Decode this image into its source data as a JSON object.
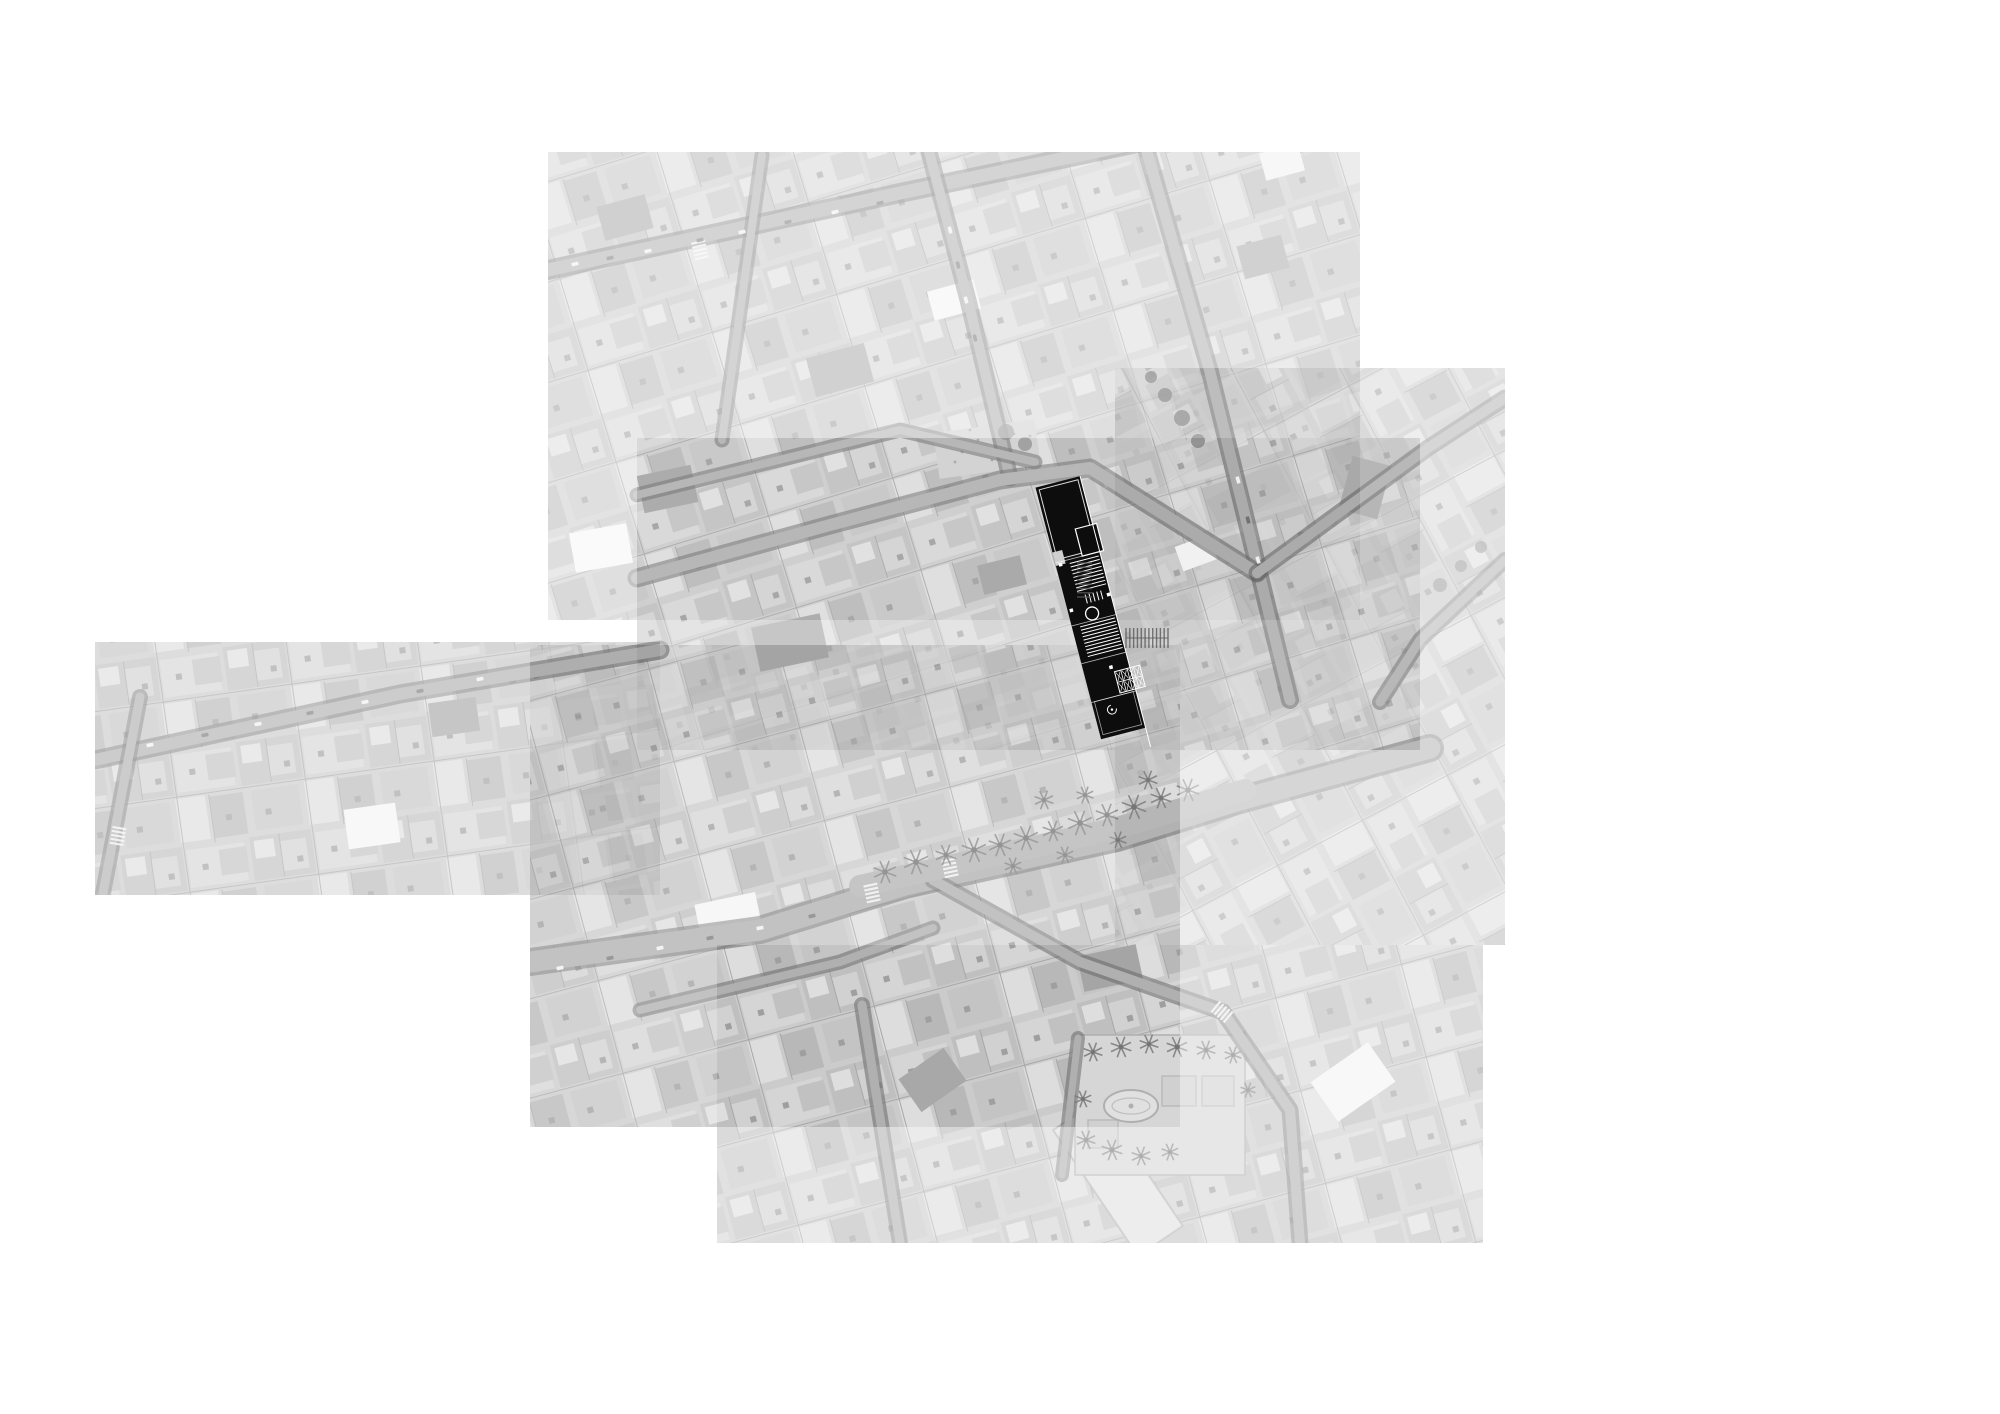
{
  "title": "aerial-orthophoto-site-montage",
  "colors": {
    "background": "#ffffff",
    "photo_base": "#bdbdbd",
    "street_dark": "#3f3f3f",
    "street_light": "#9b9b9b",
    "plan_black": "#0d0d0d",
    "plan_lines": "#ffffff",
    "palm": "#565656",
    "tree": "#6b6b6b",
    "car_light": "#ececec",
    "car_dark": "#555555",
    "plaza_fill": "#cccccc",
    "plaza_line": "#9a9a9a"
  },
  "montage": {
    "tiles": [
      {
        "name": "tile-top",
        "x": 548,
        "y": 152,
        "w": 812,
        "h": 468,
        "opacity": 0.42,
        "angle": -17
      },
      {
        "name": "tile-right",
        "x": 1115,
        "y": 368,
        "w": 390,
        "h": 577,
        "opacity": 0.4,
        "angle": 62
      },
      {
        "name": "tile-center",
        "x": 637,
        "y": 438,
        "w": 783,
        "h": 312,
        "opacity": 0.5,
        "angle": -17
      },
      {
        "name": "tile-left",
        "x": 95,
        "y": 642,
        "w": 565,
        "h": 253,
        "opacity": 0.5,
        "angle": -8
      },
      {
        "name": "tile-bottom",
        "x": 530,
        "y": 645,
        "w": 650,
        "h": 482,
        "opacity": 0.6,
        "angle": -15
      },
      {
        "name": "tile-bottom-right",
        "x": 717,
        "y": 945,
        "w": 766,
        "h": 298,
        "opacity": 0.45,
        "angle": -15
      }
    ],
    "streets": [
      {
        "name": "street-top-diagonal",
        "w": 16,
        "pts": [
          [
            548,
            270
          ],
          [
            900,
            193
          ],
          [
            1360,
            96
          ]
        ]
      },
      {
        "name": "street-top-vertical-1",
        "w": 11,
        "pts": [
          [
            762,
            155
          ],
          [
            722,
            440
          ]
        ]
      },
      {
        "name": "street-top-vertical-2",
        "w": 13,
        "pts": [
          [
            928,
            148
          ],
          [
            968,
            300
          ],
          [
            1010,
            478
          ]
        ]
      },
      {
        "name": "street-tree-lined",
        "w": 14,
        "pts": [
          [
            1147,
            152
          ],
          [
            1210,
            372
          ],
          [
            1290,
            700
          ]
        ]
      },
      {
        "name": "street-upper-center",
        "w": 11,
        "pts": [
          [
            637,
            495
          ],
          [
            900,
            430
          ],
          [
            1035,
            462
          ]
        ]
      },
      {
        "name": "street-main-center",
        "w": 15,
        "pts": [
          [
            637,
            578
          ],
          [
            830,
            525
          ],
          [
            1000,
            480
          ],
          [
            1090,
            468
          ],
          [
            1257,
            573
          ]
        ]
      },
      {
        "name": "street-right-ne-1",
        "w": 13,
        "pts": [
          [
            1257,
            573
          ],
          [
            1428,
            448
          ],
          [
            1505,
            398
          ]
        ]
      },
      {
        "name": "street-right-ne-2",
        "w": 12,
        "pts": [
          [
            1505,
            560
          ],
          [
            1420,
            640
          ],
          [
            1380,
            702
          ]
        ]
      },
      {
        "name": "street-left-west",
        "w": 15,
        "pts": [
          [
            95,
            760
          ],
          [
            400,
            694
          ],
          [
            660,
            650
          ]
        ]
      },
      {
        "name": "street-left-vertical",
        "w": 12,
        "pts": [
          [
            140,
            697
          ],
          [
            103,
            893
          ]
        ]
      },
      {
        "name": "avenue-palms",
        "w": 24,
        "pts": [
          [
            530,
            962
          ],
          [
            760,
            930
          ],
          [
            905,
            885
          ],
          [
            1117,
            838
          ],
          [
            1240,
            800
          ],
          [
            1430,
            748
          ]
        ]
      },
      {
        "name": "street-bottom-1",
        "w": 11,
        "pts": [
          [
            640,
            1010
          ],
          [
            840,
            962
          ],
          [
            933,
            928
          ]
        ]
      },
      {
        "name": "street-bottom-2",
        "w": 12,
        "pts": [
          [
            862,
            1005
          ],
          [
            900,
            1243
          ]
        ]
      },
      {
        "name": "street-plaza-edge",
        "w": 13,
        "pts": [
          [
            933,
            880
          ],
          [
            1080,
            962
          ],
          [
            1223,
            1012
          ],
          [
            1290,
            1110
          ],
          [
            1300,
            1243
          ]
        ]
      },
      {
        "name": "street-plaza-left",
        "w": 10,
        "pts": [
          [
            1078,
            1038
          ],
          [
            1062,
            1175
          ]
        ]
      }
    ],
    "median_band": {
      "w": 22,
      "pts": [
        [
          860,
          886
        ],
        [
          1117,
          828
        ],
        [
          1245,
          790
        ]
      ]
    },
    "palms_avenue": [
      [
        885,
        872,
        12
      ],
      [
        916,
        862,
        13
      ],
      [
        946,
        855,
        11
      ],
      [
        974,
        850,
        13
      ],
      [
        1000,
        845,
        12
      ],
      [
        1026,
        838,
        13
      ],
      [
        1053,
        831,
        11
      ],
      [
        1080,
        823,
        13
      ],
      [
        1107,
        815,
        12
      ],
      [
        1134,
        807,
        13
      ],
      [
        1161,
        798,
        11
      ],
      [
        1188,
        790,
        12
      ],
      [
        1013,
        866,
        9
      ],
      [
        1065,
        855,
        9
      ],
      [
        1118,
        840,
        9
      ],
      [
        1044,
        800,
        10
      ],
      [
        1085,
        795,
        9
      ],
      [
        1148,
        780,
        10
      ]
    ],
    "palms_plaza": [
      [
        1093,
        1052,
        10
      ],
      [
        1121,
        1047,
        11
      ],
      [
        1149,
        1044,
        10
      ],
      [
        1177,
        1047,
        11
      ],
      [
        1206,
        1050,
        10
      ],
      [
        1233,
        1055,
        9
      ],
      [
        1083,
        1099,
        9
      ],
      [
        1086,
        1140,
        10
      ],
      [
        1112,
        1150,
        11
      ],
      [
        1141,
        1156,
        10
      ],
      [
        1170,
        1152,
        9
      ],
      [
        1248,
        1090,
        8
      ]
    ],
    "trees": [
      [
        1165,
        395,
        7
      ],
      [
        1182,
        418,
        8
      ],
      [
        1198,
        441,
        7
      ],
      [
        1151,
        377,
        6
      ],
      [
        1440,
        585,
        7
      ],
      [
        1461,
        566,
        6
      ],
      [
        1481,
        547,
        6
      ],
      [
        1006,
        432,
        8
      ],
      [
        1025,
        444,
        7
      ]
    ],
    "cars": [
      [
        575,
        264,
        -13,
        "l"
      ],
      [
        610,
        258,
        -13,
        "d"
      ],
      [
        648,
        251,
        -13,
        "l"
      ],
      [
        700,
        240,
        -13,
        "d"
      ],
      [
        742,
        232,
        -13,
        "l"
      ],
      [
        788,
        222,
        -13,
        "d"
      ],
      [
        835,
        212,
        -13,
        "l"
      ],
      [
        880,
        203,
        -13,
        "d"
      ],
      [
        150,
        745,
        -11,
        "l"
      ],
      [
        205,
        735,
        -11,
        "d"
      ],
      [
        258,
        724,
        -11,
        "l"
      ],
      [
        310,
        713,
        -11,
        "d"
      ],
      [
        365,
        702,
        -11,
        "l"
      ],
      [
        420,
        691,
        -11,
        "d"
      ],
      [
        480,
        679,
        -11,
        "l"
      ],
      [
        560,
        968,
        -12,
        "l"
      ],
      [
        610,
        958,
        -12,
        "d"
      ],
      [
        660,
        948,
        -12,
        "l"
      ],
      [
        710,
        938,
        -12,
        "d"
      ],
      [
        760,
        928,
        -12,
        "l"
      ],
      [
        812,
        916,
        -12,
        "d"
      ],
      [
        950,
        230,
        76,
        "l"
      ],
      [
        958,
        265,
        76,
        "d"
      ],
      [
        966,
        300,
        76,
        "l"
      ],
      [
        975,
        338,
        76,
        "d"
      ],
      [
        1238,
        480,
        74,
        "l"
      ],
      [
        1248,
        520,
        74,
        "d"
      ],
      [
        1258,
        560,
        74,
        "l"
      ]
    ],
    "crosswalks": [
      [
        118,
        836,
        100
      ],
      [
        872,
        893,
        78
      ],
      [
        950,
        868,
        78
      ],
      [
        1222,
        1012,
        40
      ],
      [
        700,
        250,
        77
      ]
    ],
    "feature_blocks": [
      {
        "x": 572,
        "y": 528,
        "w": 58,
        "h": 40,
        "r": -10,
        "f": "#f4f4f4"
      },
      {
        "x": 346,
        "y": 806,
        "w": 52,
        "h": 40,
        "r": -8,
        "f": "#f2f2f2"
      },
      {
        "x": 930,
        "y": 285,
        "w": 48,
        "h": 30,
        "r": -15,
        "f": "#f2f2f2"
      },
      {
        "x": 1178,
        "y": 540,
        "w": 36,
        "h": 26,
        "r": -20,
        "f": "#efefef"
      },
      {
        "x": 698,
        "y": 898,
        "w": 62,
        "h": 42,
        "r": -12,
        "f": "#f3f3f3"
      },
      {
        "x": 1262,
        "y": 148,
        "w": 40,
        "h": 28,
        "r": -15,
        "f": "#eeeeee"
      },
      {
        "x": 1318,
        "y": 1058,
        "w": 70,
        "h": 48,
        "r": -35,
        "f": "#f1f1f1"
      },
      {
        "x": 640,
        "y": 470,
        "w": 55,
        "h": 38,
        "r": -12,
        "f": "#8b8b8b"
      },
      {
        "x": 810,
        "y": 350,
        "w": 60,
        "h": 40,
        "r": -15,
        "f": "#939393"
      },
      {
        "x": 755,
        "y": 620,
        "w": 70,
        "h": 45,
        "r": -12,
        "f": "#8e8e8e"
      },
      {
        "x": 980,
        "y": 560,
        "w": 44,
        "h": 30,
        "r": -14,
        "f": "#898989"
      },
      {
        "x": 1240,
        "y": 240,
        "w": 46,
        "h": 34,
        "r": -15,
        "f": "#949494"
      },
      {
        "x": 430,
        "y": 700,
        "w": 48,
        "h": 34,
        "r": -8,
        "f": "#8f8f8f"
      },
      {
        "x": 905,
        "y": 1060,
        "w": 55,
        "h": 40,
        "r": -35,
        "f": "#919191"
      },
      {
        "x": 1345,
        "y": 460,
        "w": 40,
        "h": 55,
        "r": 15,
        "f": "#989898"
      },
      {
        "x": 600,
        "y": 200,
        "w": 50,
        "h": 35,
        "r": -15,
        "f": "#909090"
      },
      {
        "x": 1080,
        "y": 950,
        "w": 60,
        "h": 36,
        "r": -12,
        "f": "#8d8d8d"
      }
    ],
    "garden": {
      "x": 936,
      "y": 426,
      "w": 102,
      "h": 46,
      "dots": [
        [
          948,
          438
        ],
        [
          962,
          452
        ],
        [
          978,
          440
        ],
        [
          992,
          460
        ],
        [
          1006,
          446
        ],
        [
          1020,
          458
        ],
        [
          955,
          462
        ],
        [
          1030,
          436
        ],
        [
          970,
          430
        ],
        [
          1014,
          434
        ]
      ]
    },
    "long_building": {
      "cx": 1118,
      "cy": 1178,
      "w": 152,
      "h": 54,
      "rot": 56
    },
    "plaza": {
      "x": 1075,
      "y": 1035,
      "w": 170,
      "h": 140,
      "oval": {
        "cx": 1131,
        "cy": 1106,
        "rx": 27,
        "ry": 16
      },
      "parterres": [
        [
          1162,
          1076,
          34,
          30
        ],
        [
          1202,
          1076,
          32,
          30
        ],
        [
          1088,
          1120,
          30,
          28
        ]
      ]
    },
    "pergolas": [
      {
        "x": 1126,
        "y": 628,
        "w": 42,
        "h": 20,
        "teeth": 11,
        "dir": "v"
      },
      {
        "x": 1077,
        "y": 563,
        "w": 15,
        "h": 34,
        "teeth": 8,
        "dir": "h"
      }
    ],
    "plan": {
      "rotation": -14.6,
      "cx": 1089.5,
      "cy": 609.5,
      "bar": {
        "x": 1068,
        "y": 478,
        "w": 46,
        "h": 260
      },
      "upper_outline": {
        "x": 1071,
        "y": 481,
        "w": 40,
        "h": 72
      },
      "notch": {
        "x": 1068,
        "y": 545,
        "w": 10,
        "h": 14
      },
      "outlined_box": {
        "x": 1096,
        "y": 528,
        "w": 22,
        "h": 28
      },
      "stair1": {
        "x1": 1082,
        "x2": 1112,
        "y": 560,
        "step": 3.6,
        "n": 9
      },
      "tick_block": {
        "x": 1089,
        "y": 594,
        "w": 16,
        "h": 9,
        "n": 4
      },
      "circle": {
        "cx": 1091,
        "cy": 614,
        "r": 6.5
      },
      "stair2": {
        "x1": 1076,
        "x2": 1112,
        "y": 624,
        "step": 3.4,
        "n": 10
      },
      "dividers": [
        556,
        621,
        660,
        700
      ],
      "squares": [
        [
          1070,
          604
        ],
        [
          1110,
          598
        ],
        [
          1094,
          669
        ],
        [
          1071,
          557
        ]
      ],
      "grid": {
        "x": 1098,
        "y": 676,
        "w": 26,
        "h": 22,
        "cols": 4,
        "rows": 2
      },
      "spiral": {
        "cx": 1086,
        "cy": 712,
        "r": 4.5
      },
      "bottom_outline": {
        "x": 1071,
        "y": 700,
        "w": 40,
        "h": 34
      },
      "edge_line": {
        "x": 1114,
        "y1": 478,
        "y2": 758
      }
    }
  }
}
